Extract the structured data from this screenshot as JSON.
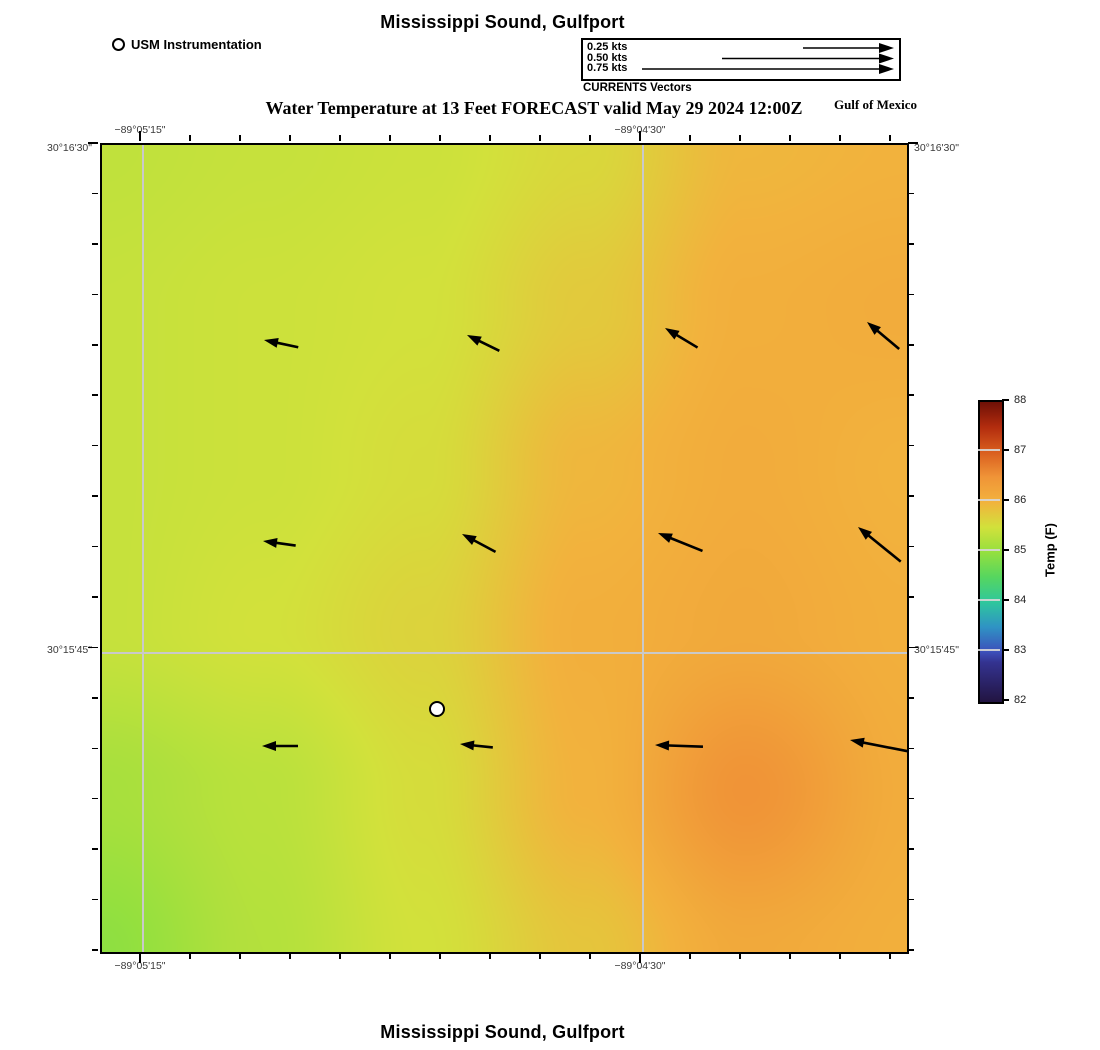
{
  "header": {
    "title": "Mississippi Sound, Gulfport",
    "subtitle": "Water Temperature at 13 Feet FORECAST valid May 29 2024 12:00Z",
    "gulf_label": "Gulf of Mexico"
  },
  "footer": {
    "title": "Mississippi Sound, Gulfport"
  },
  "usm_legend": {
    "label": "USM Instrumentation"
  },
  "currents_legend": {
    "caption": "CURRENTS Vectors",
    "rows": [
      {
        "label": "0.25 kts",
        "line_start_x": 803
      },
      {
        "label": "0.50 kts",
        "line_start_x": 722
      },
      {
        "label": "0.75 kts",
        "line_start_x": 642
      }
    ],
    "arrow_tip_x": 894,
    "row_y": [
      48,
      58.5,
      69
    ]
  },
  "axes": {
    "lon": [
      "−89°05'15\"",
      "−89°04'30\""
    ],
    "lat": [
      "30°16'30\"",
      "30°15'45\""
    ]
  },
  "colorbar": {
    "label": "Temp (F)",
    "range": [
      82,
      88
    ],
    "ticks": [
      88,
      87,
      86,
      85,
      84,
      83,
      82
    ],
    "stops": [
      [
        82.0,
        "#221441"
      ],
      [
        82.8,
        "#343391"
      ],
      [
        83.0,
        "#3d4fbb"
      ],
      [
        83.5,
        "#2f93c4"
      ],
      [
        84.0,
        "#2fc79c"
      ],
      [
        84.5,
        "#56d65f"
      ],
      [
        85.0,
        "#95e03e"
      ],
      [
        85.5,
        "#d2e13b"
      ],
      [
        86.0,
        "#f2b23d"
      ],
      [
        86.5,
        "#f09437"
      ],
      [
        87.0,
        "#d95e1e"
      ],
      [
        87.5,
        "#b22c0e"
      ],
      [
        88.0,
        "#6f1006"
      ]
    ]
  },
  "chart_data": {
    "type": "heatmap",
    "title": "Mississippi Sound, Gulfport",
    "subtitle": "Water Temperature at 13 Feet FORECAST valid May 29 2024 12:00Z",
    "x_ticks": [
      "−89°05'15\"",
      "−89°04'30\""
    ],
    "y_ticks": [
      "30°16'30\"",
      "30°15'45\""
    ],
    "colorbar_label": "Temp (F)",
    "colorbar_range": [
      82,
      88
    ],
    "temperature_grid_F": {
      "note": "approx water temps read from color field, 6x6 grid, west to east / north to south",
      "values": [
        [
          85.35,
          85.4,
          85.45,
          85.6,
          85.95,
          86.0
        ],
        [
          85.4,
          85.45,
          85.5,
          85.75,
          86.05,
          86.1
        ],
        [
          85.4,
          85.45,
          85.55,
          85.95,
          86.1,
          86.0
        ],
        [
          85.4,
          85.5,
          85.65,
          86.05,
          86.15,
          86.05
        ],
        [
          85.15,
          85.3,
          85.55,
          86.0,
          86.5,
          86.1
        ],
        [
          84.95,
          85.25,
          85.5,
          85.8,
          86.15,
          86.05
        ]
      ]
    },
    "current_vectors": {
      "units": "kts",
      "items": [
        {
          "tip_x": 264,
          "tip_y": 340,
          "dir_deg": 168,
          "len_px": 35,
          "speed_kts": 0.1
        },
        {
          "tip_x": 467,
          "tip_y": 335,
          "dir_deg": 154,
          "len_px": 36,
          "speed_kts": 0.1
        },
        {
          "tip_x": 665,
          "tip_y": 328,
          "dir_deg": 149,
          "len_px": 38,
          "speed_kts": 0.11
        },
        {
          "tip_x": 867,
          "tip_y": 322,
          "dir_deg": 140,
          "len_px": 42,
          "speed_kts": 0.12
        },
        {
          "tip_x": 263,
          "tip_y": 541,
          "dir_deg": 172,
          "len_px": 33,
          "speed_kts": 0.09
        },
        {
          "tip_x": 462,
          "tip_y": 534,
          "dir_deg": 152,
          "len_px": 38,
          "speed_kts": 0.11
        },
        {
          "tip_x": 658,
          "tip_y": 533,
          "dir_deg": 158,
          "len_px": 48,
          "speed_kts": 0.13
        },
        {
          "tip_x": 858,
          "tip_y": 527,
          "dir_deg": 141,
          "len_px": 55,
          "speed_kts": 0.15
        },
        {
          "tip_x": 262,
          "tip_y": 746,
          "dir_deg": 180,
          "len_px": 36,
          "speed_kts": 0.1
        },
        {
          "tip_x": 460,
          "tip_y": 744,
          "dir_deg": 174,
          "len_px": 33,
          "speed_kts": 0.09
        },
        {
          "tip_x": 655,
          "tip_y": 745,
          "dir_deg": 178,
          "len_px": 48,
          "speed_kts": 0.13
        },
        {
          "tip_x": 850,
          "tip_y": 740,
          "dir_deg": 169,
          "len_px": 60,
          "speed_kts": 0.17
        }
      ]
    },
    "station": {
      "label": "USM Instrumentation",
      "x_px": 437,
      "y_px": 709
    }
  }
}
